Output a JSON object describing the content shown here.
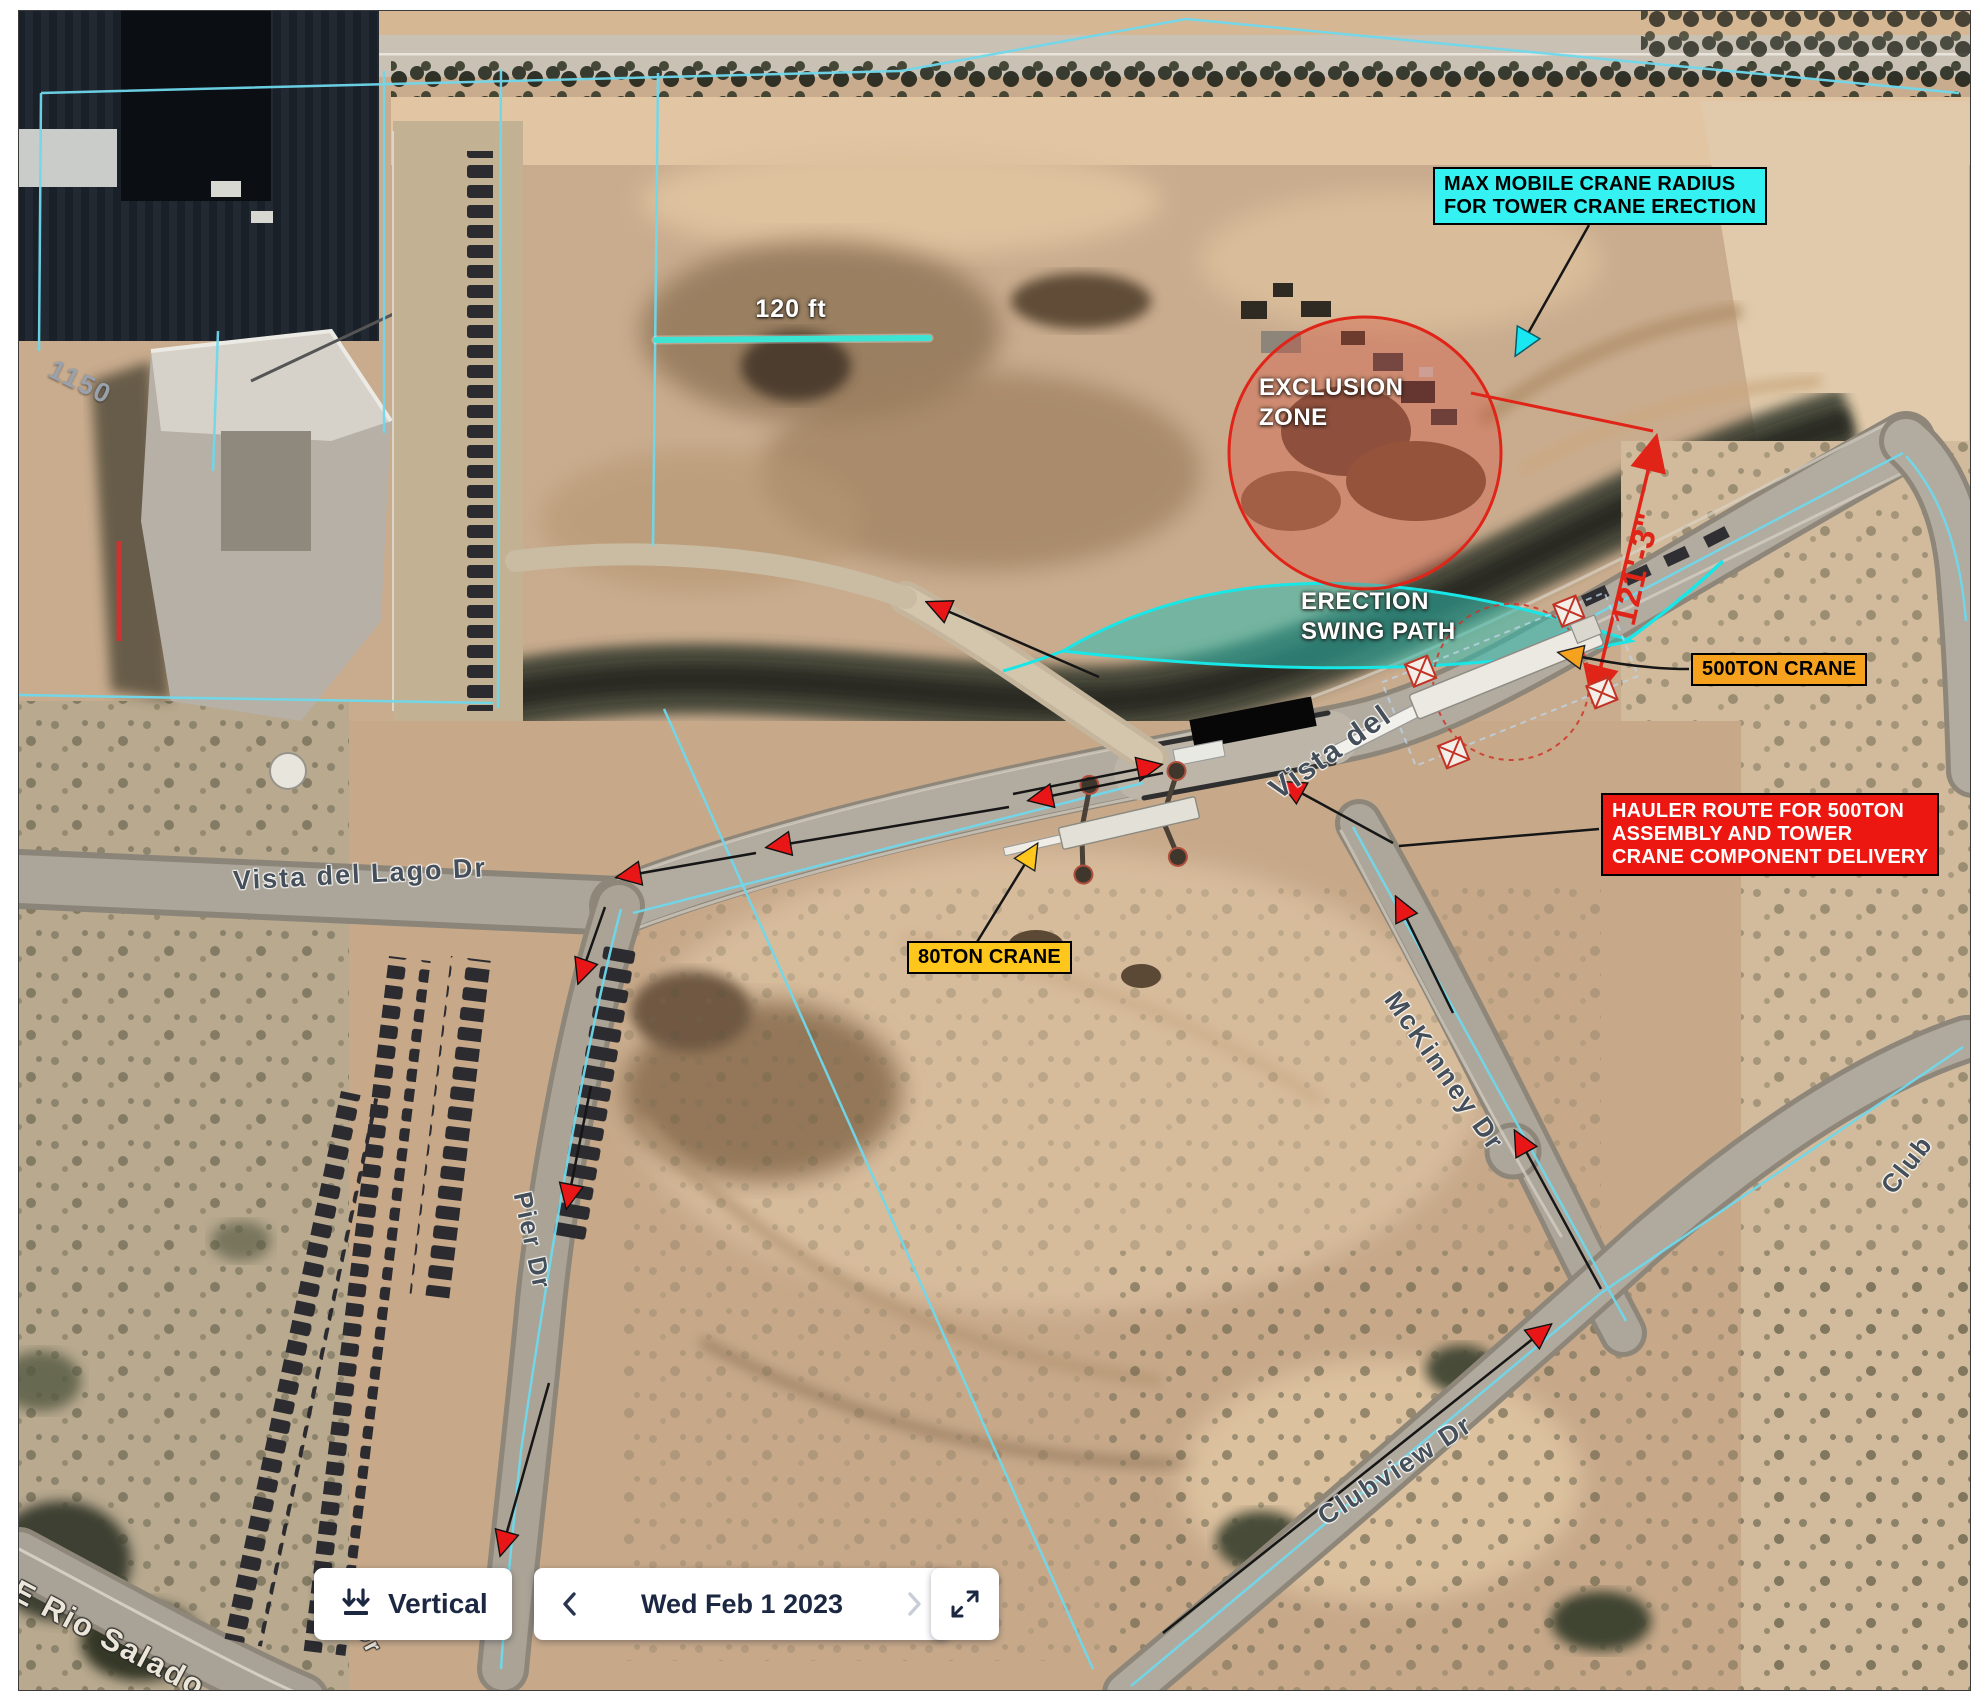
{
  "map": {
    "scale_bar": {
      "label": "120 ft",
      "color": "#3ce4d4"
    },
    "building_number": "1150",
    "streets": {
      "vista_del_lago": "Vista del Lago Dr",
      "vista_del": "Vista del",
      "mckinney": "McKinney Dr",
      "clubview": "Clubview Dr",
      "club_partial": "Club",
      "pier": "Pier Dr",
      "rio_salado": "E Rio Salado",
      "dr_partial": "Dr"
    },
    "annotations": {
      "max_crane_radius": {
        "line1": "MAX MOBILE CRANE RADIUS",
        "line2": "FOR TOWER CRANE ERECTION",
        "color": "#35f1f1"
      },
      "exclusion_zone": {
        "line1": "EXCLUSION",
        "line2": "ZONE",
        "circle_color": "#e02418"
      },
      "erection_swing_path": {
        "line1": "ERECTION",
        "line2": "SWING PATH",
        "fill_color": "#2fbcae",
        "edge_color": "#19e6e6"
      },
      "crane_500t": {
        "label": "500TON CRANE",
        "color": "#f6a21f"
      },
      "crane_80t": {
        "label": "80TON CRANE",
        "color": "#ffc71c"
      },
      "hauler_route": {
        "line1": "HAULER ROUTE FOR 500TON",
        "line2": "ASSEMBLY AND TOWER",
        "line3": "CRANE COMPONENT DELIVERY",
        "color": "#ec1711"
      },
      "dimension": {
        "label": "121'-3\"",
        "color": "#e02418"
      }
    }
  },
  "toolbar": {
    "vertical": {
      "label": "Vertical",
      "icon": "double-down-arrow-icon"
    },
    "date_picker": {
      "date": "Wed Feb 1 2023",
      "prev_icon": "chevron-left-icon",
      "next_icon": "chevron-right-icon"
    },
    "expand": {
      "icon": "expand-icon"
    },
    "text_color": "#1c2742"
  }
}
